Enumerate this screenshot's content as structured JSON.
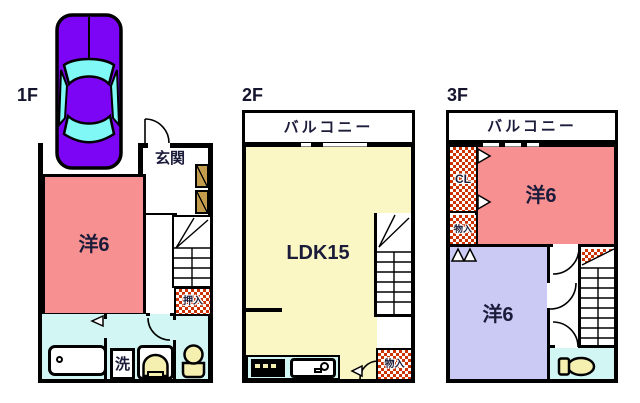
{
  "colors": {
    "room_pink": "#f79090",
    "room_yellow": "#fbf7c4",
    "room_lavender": "#cacaf5",
    "wet_cyan": "#d2f6f4",
    "checker_red": "#cc3300",
    "cabinet_brown": "#c29b4d",
    "car_purple": "#7d05f5",
    "car_glass": "#7ff8f6",
    "fixture_cream": "#f6f0b0",
    "label_ink": "#1b1b3a"
  },
  "floor1": {
    "label": "1F",
    "entrance": "玄関",
    "room": "洋6",
    "closet": "押入",
    "laundry": "洗"
  },
  "floor2": {
    "label": "2F",
    "balcony": "バルコニー",
    "room": "LDK15",
    "storage": "物入"
  },
  "floor3": {
    "label": "3F",
    "balcony": "バルコニー",
    "closet": "CL",
    "storage": "物入",
    "room_upper": "洋6",
    "room_lower": "洋6"
  }
}
